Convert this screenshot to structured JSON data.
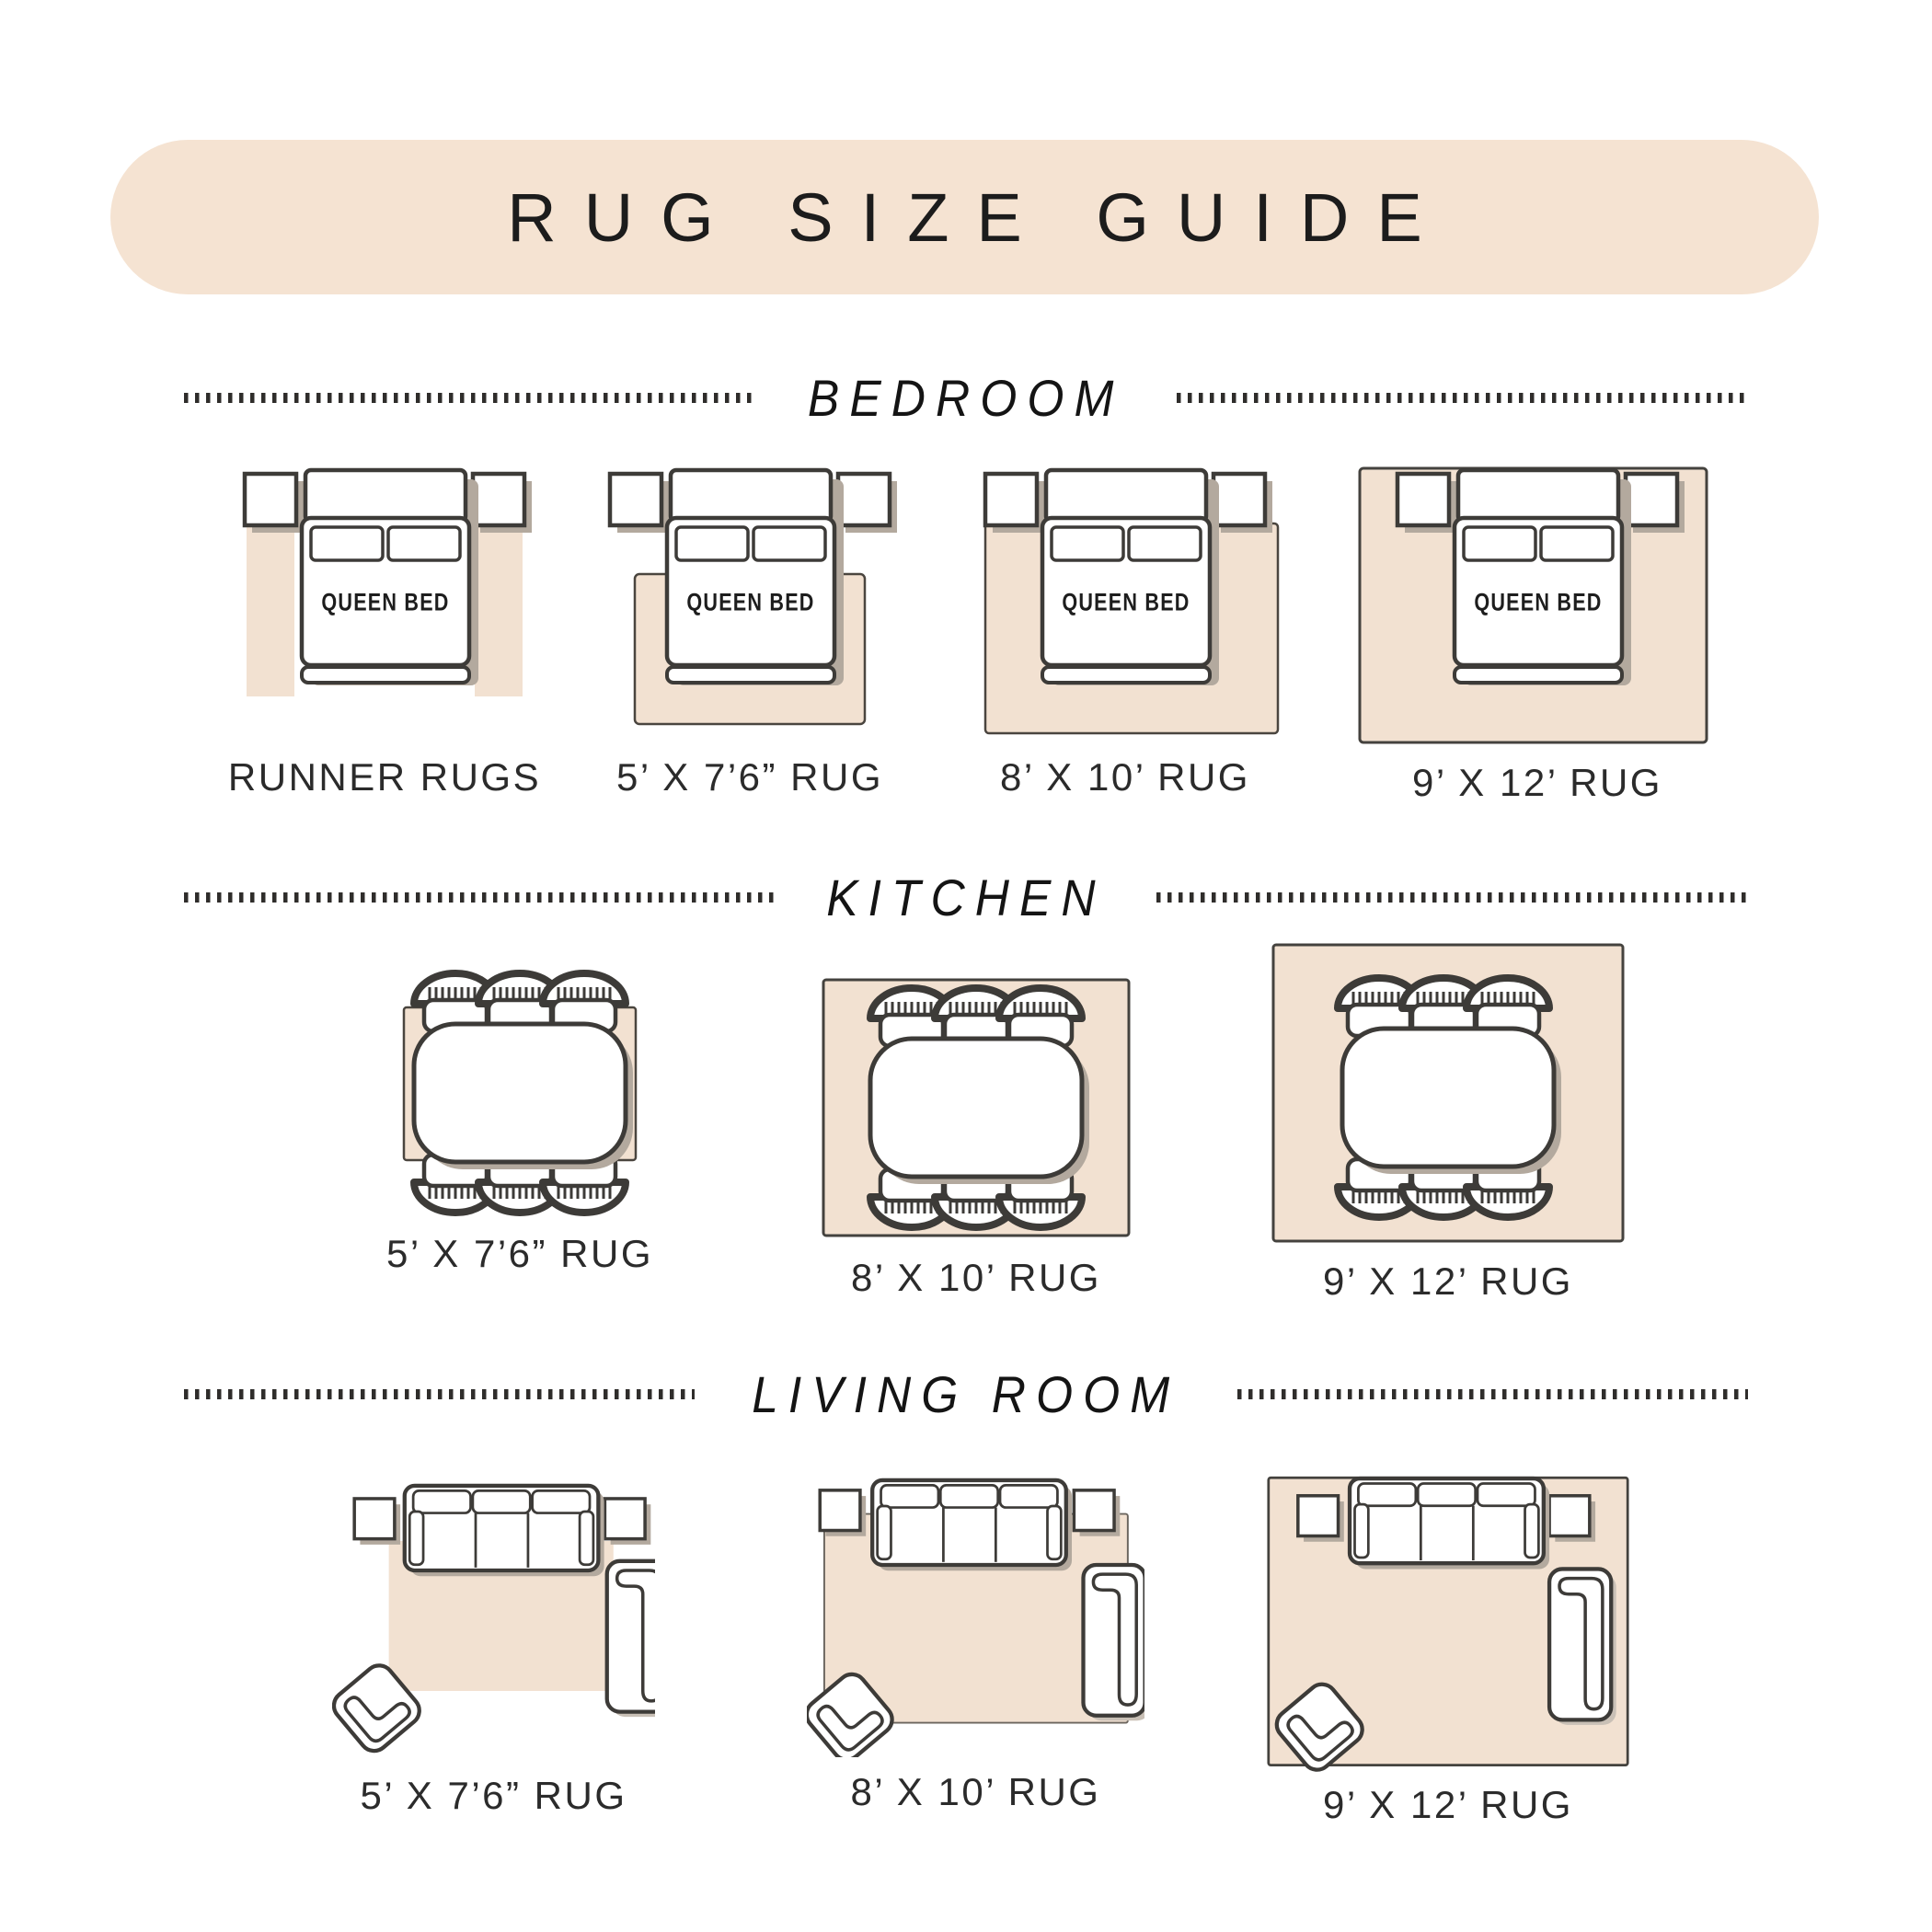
{
  "title": "RUG SIZE GUIDE",
  "furniture": {
    "queen_bed_label": "QUEEN BED"
  },
  "sections": {
    "bedroom": {
      "label": "BEDROOM",
      "items": [
        "RUNNER RUGS",
        "5’ X 7’6” RUG",
        "8’ X 10’ RUG",
        "9’ X 12’ RUG"
      ]
    },
    "kitchen": {
      "label": "KITCHEN",
      "items": [
        "5’ X 7’6” RUG",
        "8’ X 10’ RUG",
        "9’ X 12’ RUG"
      ]
    },
    "living_room": {
      "label": "LIVING ROOM",
      "items": [
        "5’ X 7’6” RUG",
        "8’ X 10’ RUG",
        "9’ X 12’ RUG"
      ]
    }
  },
  "colors": {
    "banner": "#f5e3d2",
    "rug": "#f2e1d1",
    "outline": "#3d3b38",
    "shadow": "#b3a99e",
    "text": "#1c1c1c"
  }
}
